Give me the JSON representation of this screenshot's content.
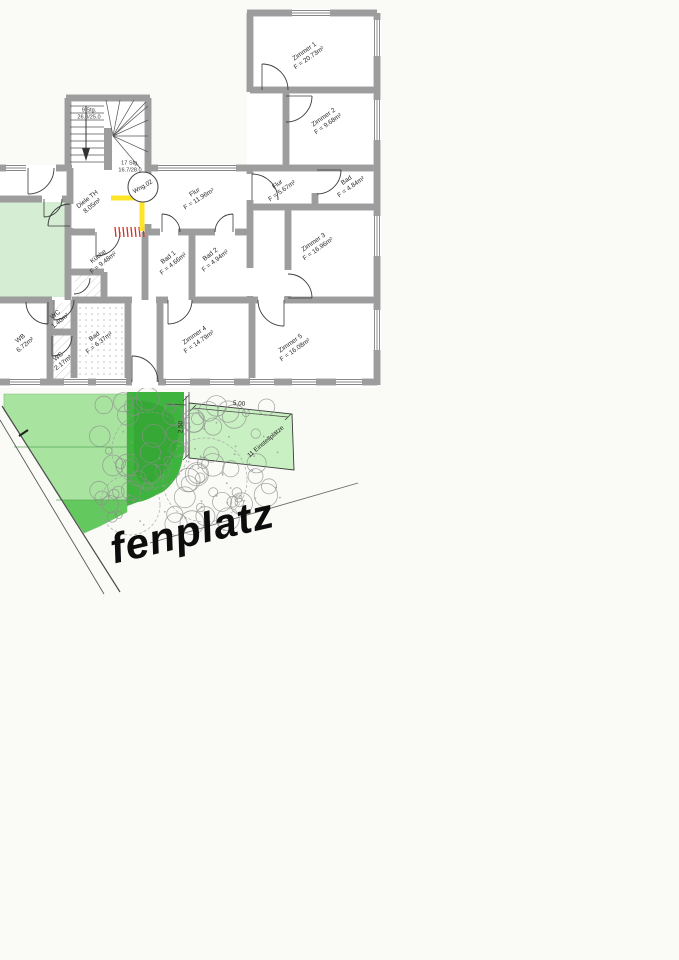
{
  "plan": {
    "apartment_badge": "Wng.02",
    "stairs": {
      "upper": "9 Stg.",
      "upper_dim": "26.0/25.0",
      "lower": "17 Stg.",
      "lower_dim": "16.7/28.0"
    },
    "rooms": [
      {
        "name": "Zimmer 1",
        "area": "F = 20.73m²"
      },
      {
        "name": "Zimmer 2",
        "area": "F = 9.68m²"
      },
      {
        "name": "Flur",
        "area": "F = 11.96m²"
      },
      {
        "name": "Diele TH",
        "area": "8.05m²"
      },
      {
        "name": "Flur",
        "area": "F = 5.67m²"
      },
      {
        "name": "Bad",
        "area": "F = 4.84m²"
      },
      {
        "name": "Zimmer 3",
        "area": "F = 16.96m²"
      },
      {
        "name": "Küche",
        "area": "F = 9.48m²"
      },
      {
        "name": "Bad 1",
        "area": "F = 4.66m²"
      },
      {
        "name": "Bad 2",
        "area": "F = 4.94m²"
      },
      {
        "name": "WB",
        "area": "6.72m²"
      },
      {
        "name": "WC",
        "area": "1.40m²"
      },
      {
        "name": "WC",
        "area": "2.17m²"
      },
      {
        "name": "Bad",
        "area": "F = 6.37m²"
      },
      {
        "name": "Zimmer 4",
        "area": "F = 14.79m²"
      },
      {
        "name": "Zimmer 5",
        "area": "F = 16.08m²"
      }
    ]
  },
  "site": {
    "street_label": "fenplatz",
    "parking_width": "5.00",
    "parking_depth": "2.50",
    "parking_label": "11 Einstellplätze"
  },
  "colors": {
    "highlight_yellow": "#ffe41c",
    "marker_red": "#d63020",
    "garden_green": "#a8e39f",
    "garden_dark_band": "#63c95e",
    "canopy_green": "#3eb43e",
    "parking_green": "#c9f0c2",
    "room_green": "#d5edd3",
    "wall_gray": "#9a9a9a"
  }
}
